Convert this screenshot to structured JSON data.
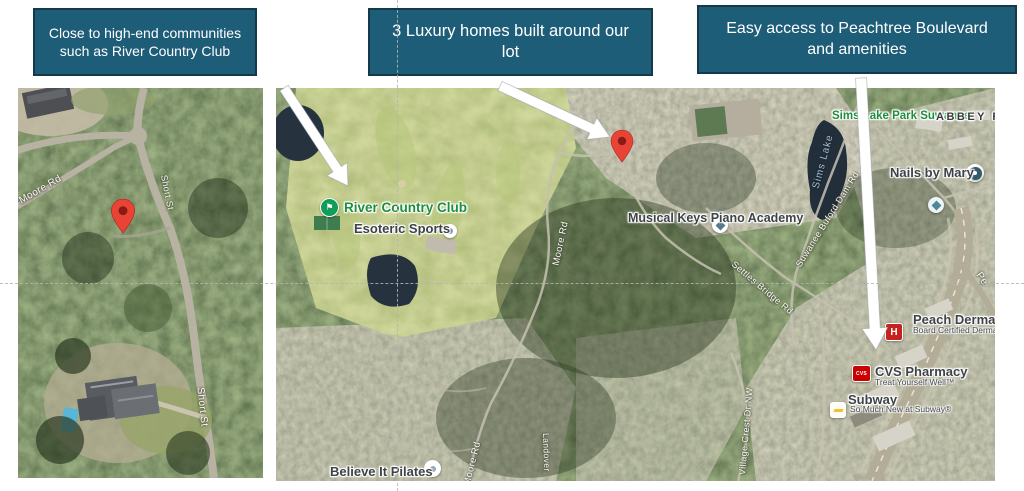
{
  "slide": {
    "background": "#FFFFFF"
  },
  "callouts": [
    {
      "lines": [
        "Close to high-end communities",
        "such as River Country Club"
      ]
    },
    {
      "lines": [
        "3 Luxury homes built around our",
        "lot"
      ]
    },
    {
      "lines": [
        "Easy access to Peachtree Boulevard",
        "and amenities"
      ]
    }
  ],
  "colors": {
    "callout_bg": "#1E5D78",
    "callout_border": "#14394B",
    "callout_text": "#FFFFFF",
    "pin_red": "#E94335",
    "poi_green": "#1E8E3E",
    "road_label": "#FFFFFF",
    "water": "#26333F",
    "arrow": "#FFFFFF"
  },
  "left_map": {
    "roads": {
      "moore_rd": "Moore Rd",
      "short_st_upper": "Short St",
      "short_st_lower": "Short St"
    }
  },
  "right_map": {
    "pois": {
      "river_country_club": "River Country Club",
      "esoteric_sports": "Esoteric Sports",
      "musical_keys": [
        "Musical Keys",
        "Piano Academy"
      ],
      "sims_lake_park": [
        "Sims Lake",
        "Park Suwanee"
      ],
      "abbey": "ABBEY R",
      "nails_by_mary": "Nails by Mary",
      "peach_dermatology": {
        "name": "Peach Dermat",
        "icon_letter": "H",
        "sub": [
          "Board Certified",
          "Dermatologist"
        ]
      },
      "cvs": {
        "name": "CVS Pharmacy",
        "icon_text": "CVS",
        "sub": "Treat Yourself Well™"
      },
      "subway": {
        "name": "Subway",
        "sub": [
          "So Much New",
          "at Subway®"
        ]
      },
      "pilates": "Believe It Pilates"
    },
    "roads": {
      "moore_rd_upper": "Moore Rd",
      "moore_rd_lower": "Moore Rd",
      "suwanee_buford_dam": "Suwanee Buford Dam Rd",
      "settles_bridge": "Settles Bridge Rd",
      "village_crest": "Village Crest Dr NW",
      "landover": "Landover",
      "peachtree_partial": "Pe"
    },
    "water_labels": {
      "sims_lake": "Sims Lake"
    }
  }
}
